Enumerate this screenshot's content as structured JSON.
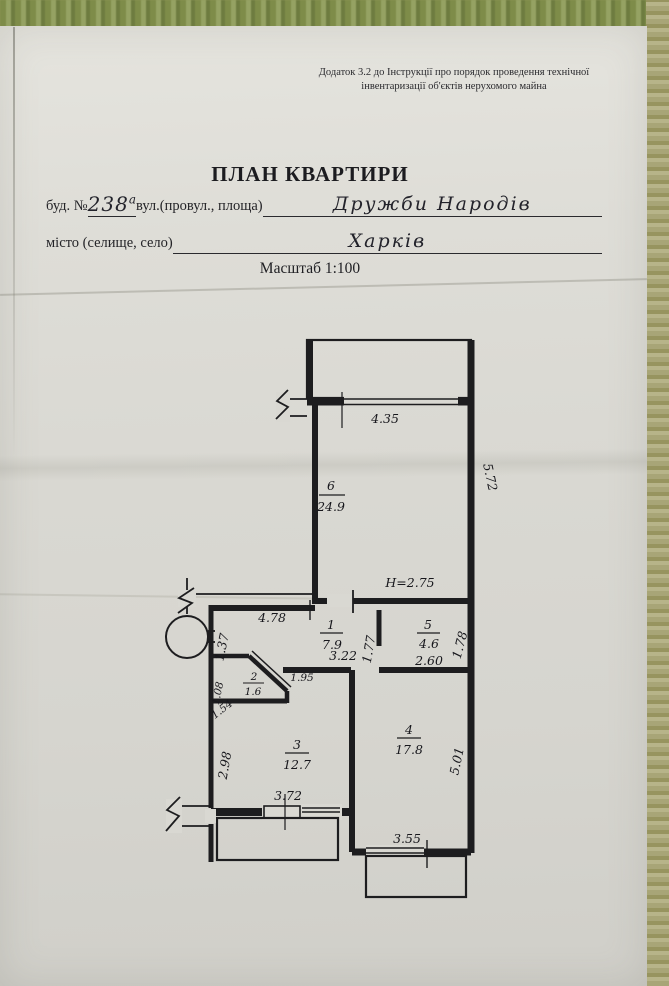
{
  "photo": {
    "background_top_green": "#7e8c49",
    "background_right_khaki": "#a8a577",
    "paper_color": "#d9d8d2",
    "ink_color": "#1d1d1f"
  },
  "doc": {
    "note_line1": "Додаток 3.2 до Інструкції про порядок проведення технічної",
    "note_line2": "інвентаризації об'єктів нерухомого майна",
    "title": "ПЛАН КВАРТИРИ",
    "field_building_label": "буд. №",
    "field_building_value": "238",
    "field_building_sup": "а",
    "field_street_label": "вул.(провул., площа)",
    "field_street_value": "Дружби Народів",
    "field_city_label": "місто (селище, село)",
    "field_city_value": "Харків",
    "scale_label": "Масштаб 1:100"
  },
  "plan": {
    "height_note": "H=2.75",
    "rooms": {
      "r1": {
        "num": "1",
        "area": "7.9"
      },
      "r2": {
        "num": "2",
        "area": "1.6"
      },
      "r3": {
        "num": "3",
        "area": "12.7"
      },
      "r4": {
        "num": "4",
        "area": "17.8"
      },
      "r5": {
        "num": "5",
        "area": "4.6"
      },
      "r6": {
        "num": "6",
        "area": "24.9"
      }
    },
    "dims": {
      "win6": "4.35",
      "r6_right": "5.72",
      "r1_top": "4.78",
      "r1_left": "1.37",
      "r1_bottom": "3.22",
      "r5_left": "1.77",
      "r5_right": "1.78",
      "r5_bottom": "2.60",
      "r2_left": "1.08",
      "r2_diag": "1.54",
      "hall": "1.95",
      "r3_left": "2.98",
      "r3_bottom": "3.72",
      "r4_right": "5.01",
      "r4_bottom": "3.55"
    }
  }
}
